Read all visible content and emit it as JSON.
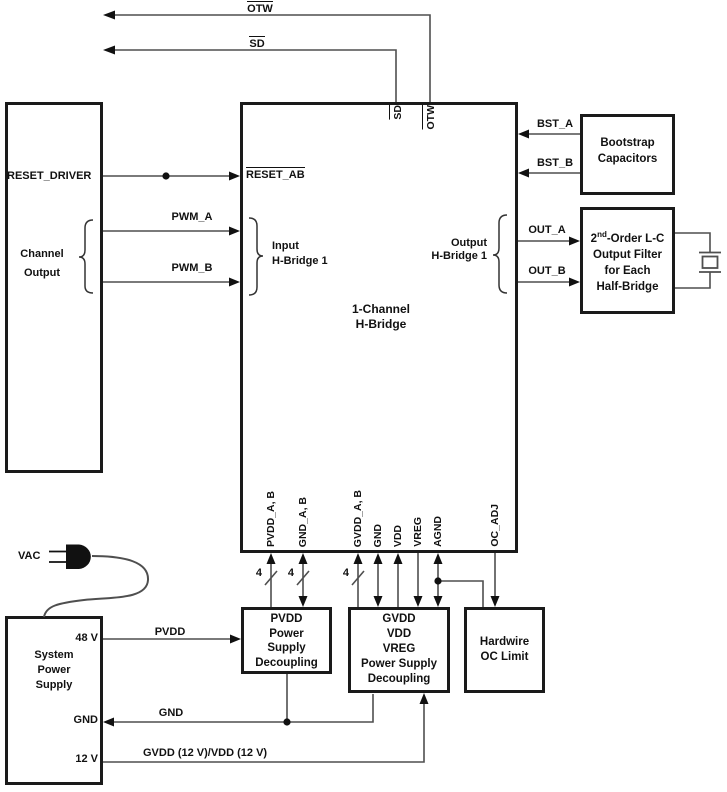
{
  "colors": {
    "ink": "#111111",
    "wire": "#4f4f4f",
    "background": "#ffffff"
  },
  "top_signals": {
    "otw": "OTW",
    "sd": "SD"
  },
  "left_source": {
    "reset_driver": "RESET_DRIVER",
    "channel_output_line1": "Channel",
    "channel_output_line2": "Output",
    "pwm_a": "PWM_A",
    "pwm_b": "PWM_B"
  },
  "main_block": {
    "title_line1": "1-Channel",
    "title_line2": "H-Bridge",
    "reset_ab": "RESET_AB",
    "sd_pin": "SD",
    "otw_pin": "OTW",
    "input_label_line1": "Input",
    "input_label_line2": "H-Bridge 1",
    "output_label_line1": "Output",
    "output_label_line2": "H-Bridge 1",
    "bottom_pins": [
      "PVDD_A, B",
      "GND_A, B",
      "GVDD_A, B",
      "GND",
      "VDD",
      "VREG",
      "AGND",
      "OC_ADJ"
    ]
  },
  "right_side": {
    "bst_a": "BST_A",
    "bst_b": "BST_B",
    "bootstrap_line1": "Bootstrap",
    "bootstrap_line2": "Capacitors",
    "out_a": "OUT_A",
    "out_b": "OUT_B",
    "filter_line1_base": "2",
    "filter_line1_sup": "nd",
    "filter_line1_rest": "-Order L-C",
    "filter_line2": "Output Filter",
    "filter_line3": "for Each",
    "filter_line4": "Half-Bridge"
  },
  "bottom": {
    "bus_markers": [
      "4",
      "4",
      "4"
    ],
    "pvdd_block": [
      "PVDD",
      "Power",
      "Supply",
      "Decoupling"
    ],
    "gvdd_block": [
      "GVDD",
      "VDD",
      "VREG",
      "Power Supply",
      "Decoupling"
    ],
    "hardwire_block": [
      "Hardwire",
      "OC Limit"
    ],
    "pvdd_net": "PVDD",
    "gnd_net": "GND",
    "gvdd_net": "GVDD (12 V)/VDD (12 V)"
  },
  "power_supply": {
    "vac": "VAC",
    "block_line1": "System",
    "block_line2": "Power",
    "block_line3": "Supply",
    "out_48": "48 V",
    "out_gnd": "GND",
    "out_12": "12 V"
  }
}
